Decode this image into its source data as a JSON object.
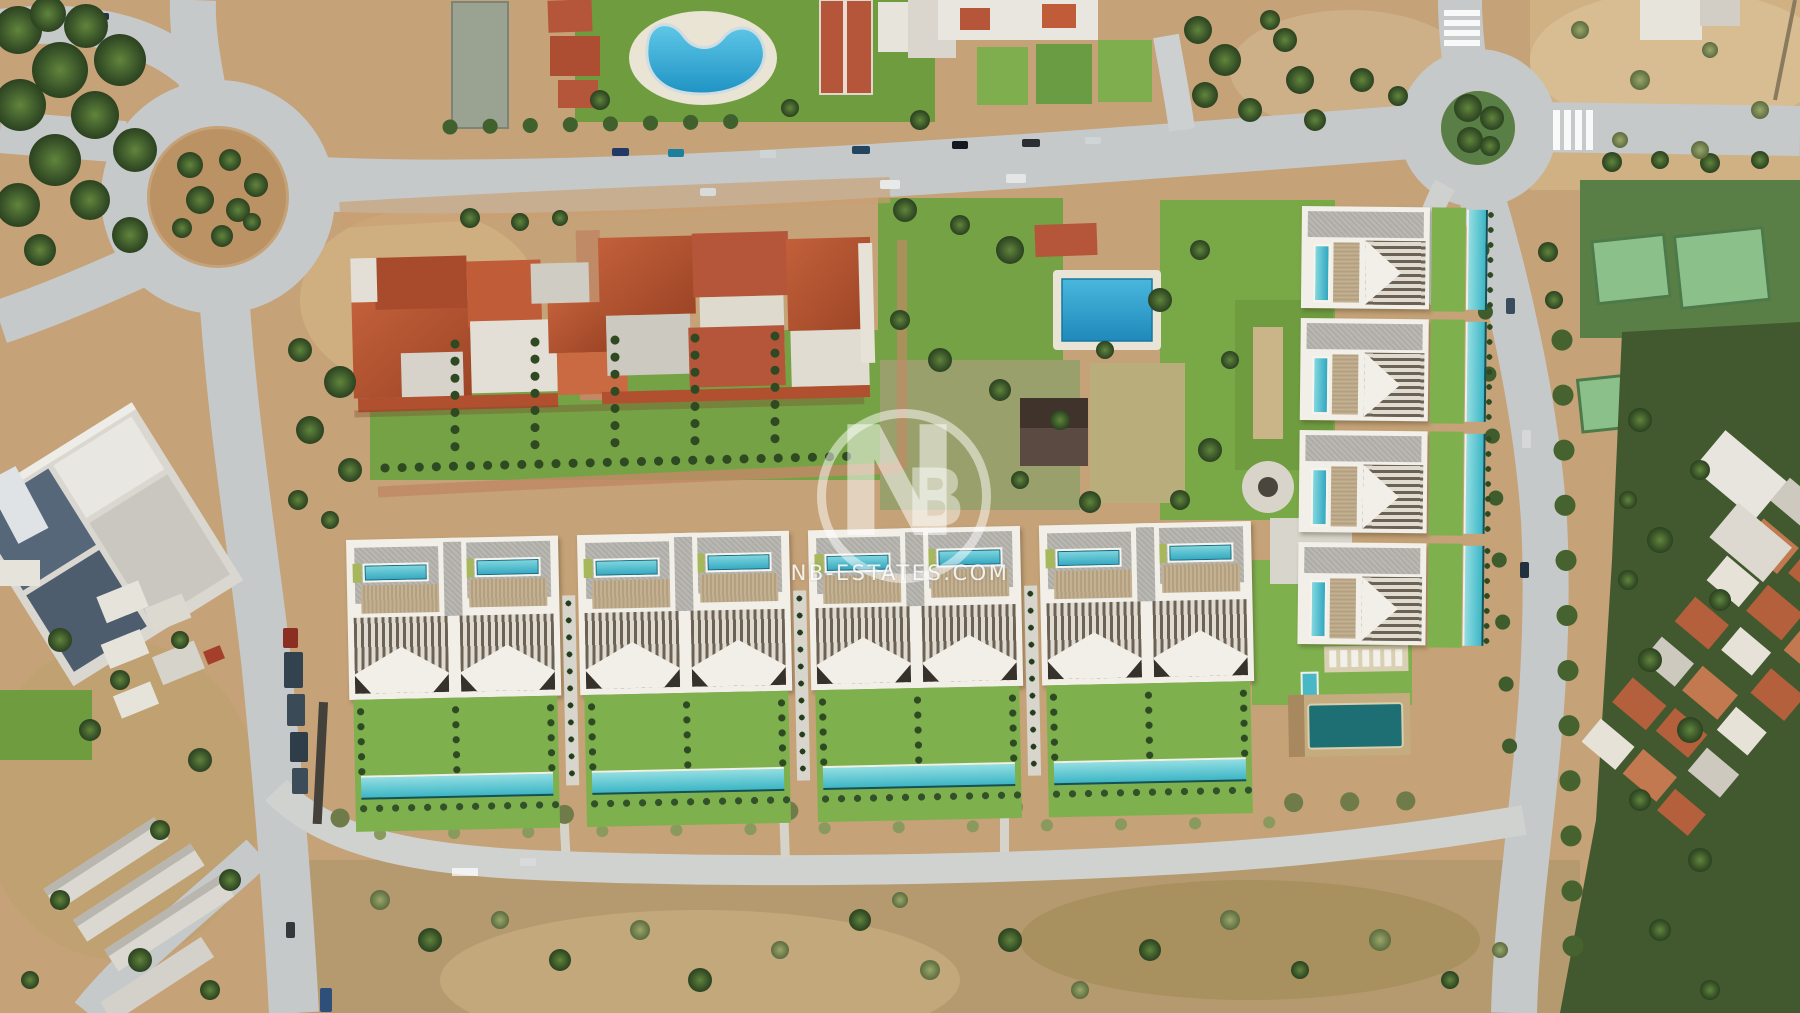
{
  "watermark": {
    "monogram": "NB",
    "monogram_n": "N",
    "monogram_b": "B",
    "domain_text": "NB-ESTATES.COM",
    "color": "#ffffff"
  },
  "palette": {
    "dirt": "#c5a277",
    "scrub_dirt": "#b59a6f",
    "road_asphalt": "#c6c9ca",
    "access_road": "#d0d2cf",
    "lawn_photo": "#6f9c3f",
    "lawn_render": "#7fb04e",
    "pool_photo_blue": "#2aa9d2",
    "pool_render_teal": "#49c0cc",
    "pool_dark_teal": "#1d6f74",
    "roof_terracotta": "#b1502f",
    "building_white": "#e9e6de",
    "tree_dark_green": "#3a5529",
    "olive_scrub": "#7d8a55",
    "louver_brown": "#6b6154",
    "wood_deck": "#bfae8d",
    "gravel_roof": "#b6b4ae"
  }
}
